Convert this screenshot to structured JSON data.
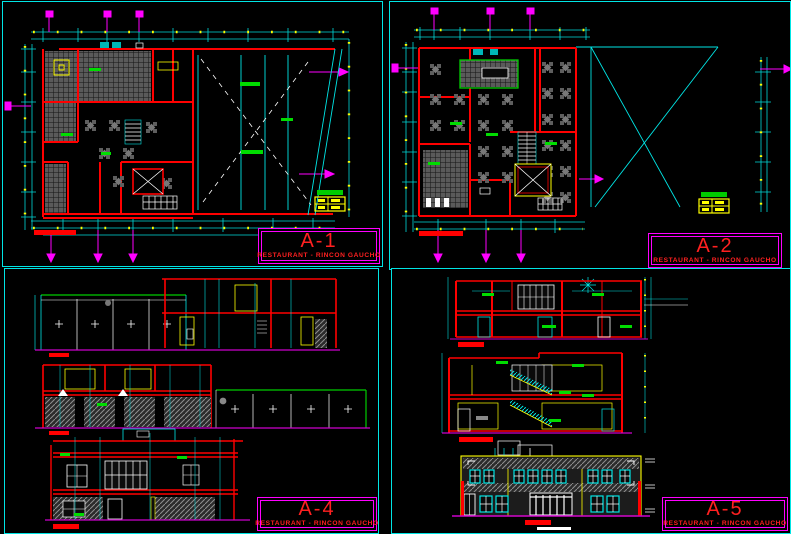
{
  "canvas": {
    "background": "#000000",
    "viewport_border": "#00E5E5"
  },
  "palette": {
    "walls": "#FF0000",
    "dimensions": "#00D9D9",
    "dimension_ticks": "#FFFF00",
    "section_markers": "#FF00FF",
    "ground_line": "#CC00CC",
    "green_marks": "#00CC00",
    "fixtures": "#FFFF00",
    "detail_white": "#FFFFFF",
    "floor_hatch": "#5A5A5A"
  },
  "title_blocks": {
    "border_color": "#FF00FF",
    "text_color": "#FF0000",
    "underline_color": "#00CC00",
    "sheets": [
      {
        "id": "A-1",
        "subtitle": "RESTAURANT - RINCON GAUCHO"
      },
      {
        "id": "A-2",
        "subtitle": "RESTAURANT - RINCON GAUCHO"
      },
      {
        "id": "A-4",
        "subtitle": "RESTAURANT - RINCON GAUCHO"
      },
      {
        "id": "A-5",
        "subtitle": "RESTAURANT - RINCON GAUCHO"
      }
    ]
  }
}
